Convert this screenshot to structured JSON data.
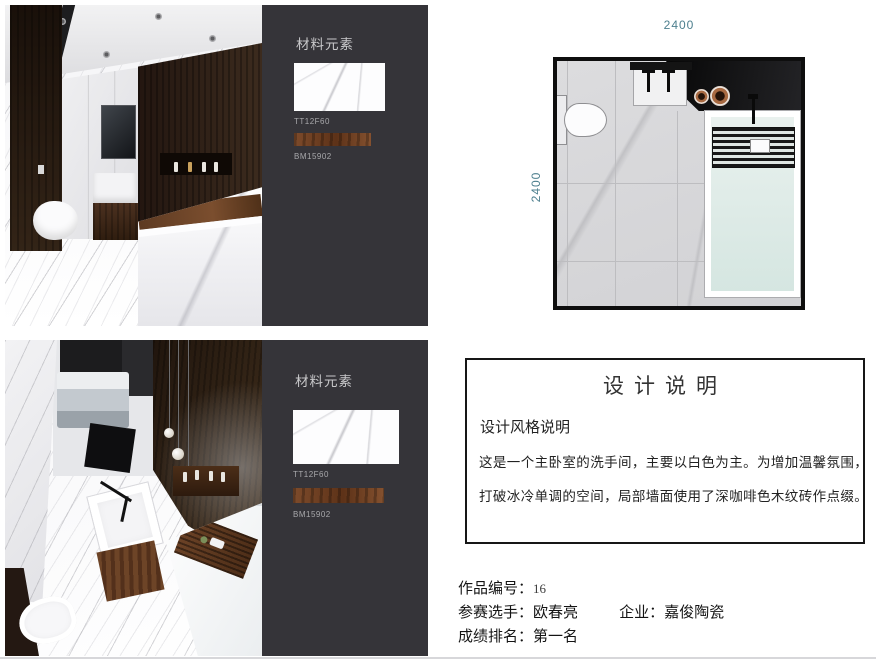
{
  "materials": {
    "title": "材料元素",
    "tile_label": "TT12F60",
    "wood_label": "BM15902"
  },
  "floor_plan": {
    "top_dim": "2400",
    "left_dim": "2400"
  },
  "design_notes": {
    "title": "设计说明",
    "style_heading": "设计风格说明",
    "body_line1": "这是一个主卧室的洗手间，主要以白色为主。为增加温馨氛围，",
    "body_line2": "打破冰冷单调的空间，局部墙面使用了深咖啡色木纹砖作点缀。"
  },
  "footer": {
    "entry_label": "作品编号：",
    "entry_value": "16",
    "contestant_label": "参赛选手：",
    "contestant_value": "欧春亮",
    "company_label": "企业：",
    "company_value": "嘉俊陶瓷",
    "rank_label": "成绩排名：",
    "rank_value": "第一名"
  },
  "colors": {
    "dimension_text": "#4d7f8e",
    "panel_background": "#353439",
    "accent_wood": "#6b4226",
    "tub_water": "#d5e6e1"
  }
}
